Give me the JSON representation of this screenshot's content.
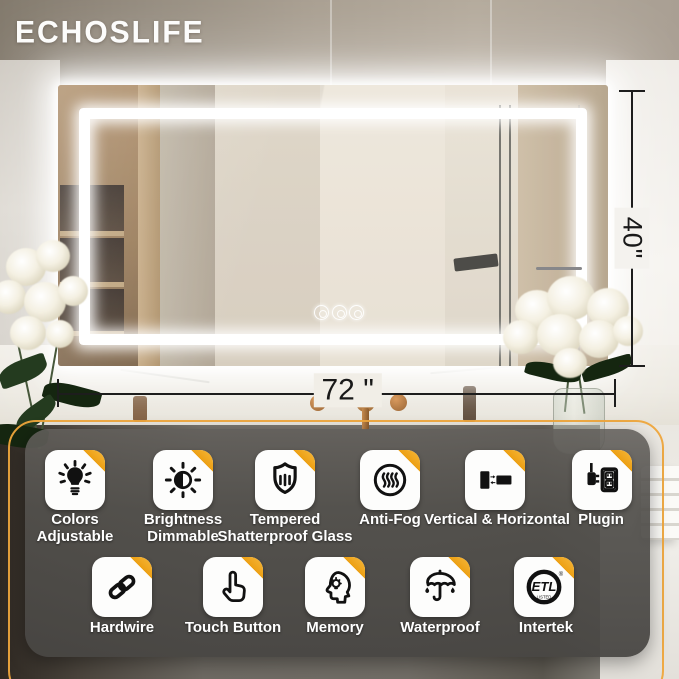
{
  "brand": {
    "logo_text": "ECHOSLIFE"
  },
  "annotations": {
    "height_label": "40\"",
    "width_label": "72 \""
  },
  "mirror": {
    "touch_button_count": "3"
  },
  "features": {
    "row1": [
      {
        "label": "Colors Adjustable",
        "icon": "color-bulb-icon"
      },
      {
        "label": "Brightness Dimmable",
        "icon": "brightness-icon"
      },
      {
        "label": "Tempered Shatterproof Glass",
        "icon": "shield-glass-icon"
      },
      {
        "label": "Anti-Fog",
        "icon": "anti-fog-icon"
      },
      {
        "label": "Vertical & Horizontal",
        "icon": "orientation-icon"
      },
      {
        "label": "Plugin",
        "icon": "plug-outlet-icon"
      }
    ],
    "row2": [
      {
        "label": "Hardwire",
        "icon": "chain-link-icon"
      },
      {
        "label": "Touch Button",
        "icon": "touch-hand-icon"
      },
      {
        "label": "Memory",
        "icon": "memory-head-icon"
      },
      {
        "label": "Waterproof",
        "icon": "umbrella-icon"
      },
      {
        "label": "Intertek",
        "icon": "etl-listed-logo"
      }
    ]
  },
  "certification": {
    "mark": "ETL",
    "listed": "LISTED",
    "registered": "®"
  },
  "colors": {
    "accent_gold": "#EFA63C",
    "fold_orange": "#EDA014",
    "panel_gray": "#55534F",
    "label_white": "#FFFFFF",
    "dimension_line": "#1D1D1D"
  }
}
